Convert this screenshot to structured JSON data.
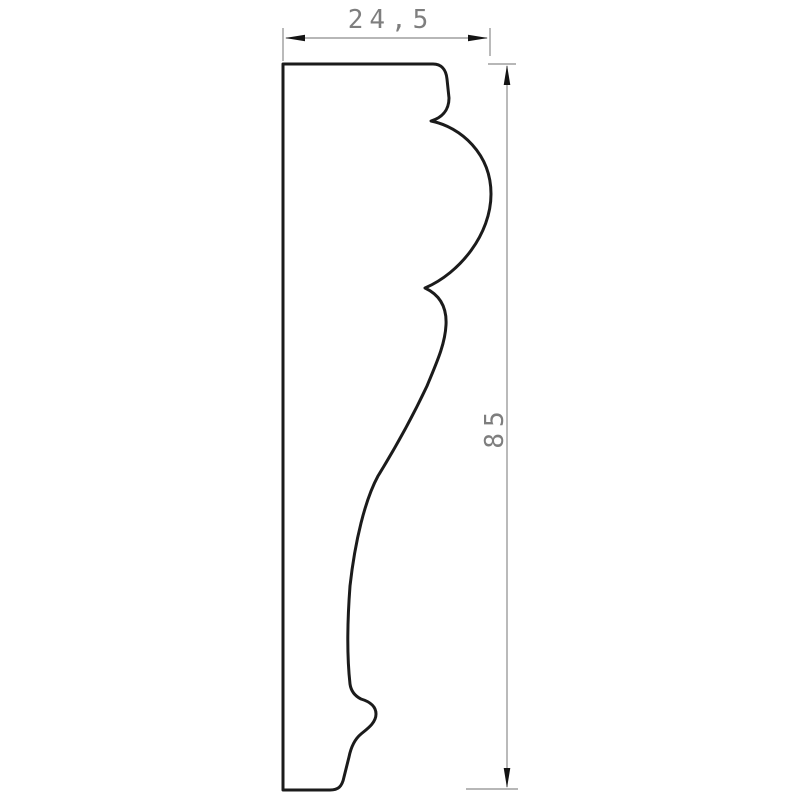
{
  "drawing": {
    "type": "technical-profile-cross-section",
    "subject": "decorative moulding profile",
    "dimensions": {
      "width_label": "24,5",
      "height_label": "85"
    }
  },
  "colors": {
    "background": "#ffffff",
    "outline": "#1b1b1b",
    "dimension_line": "#8c8c8c",
    "arrowhead": "#141414",
    "dimension_text": "#7e7e7e"
  }
}
